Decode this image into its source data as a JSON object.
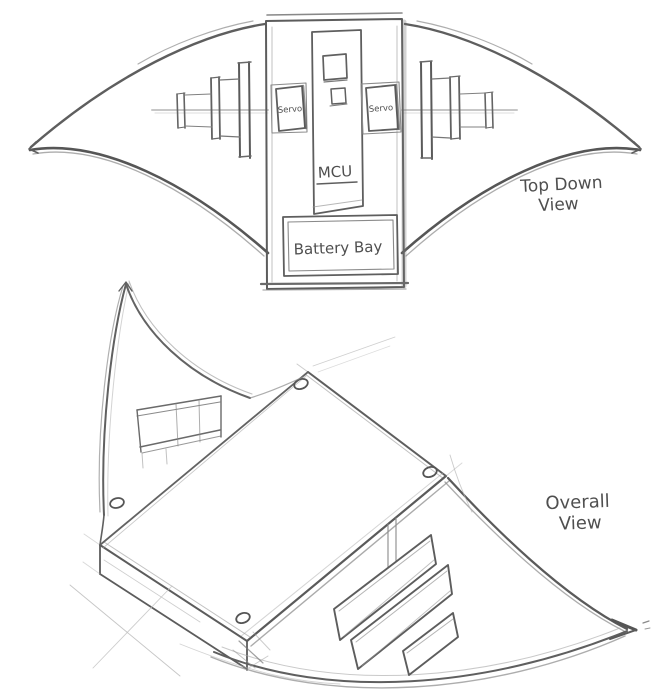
{
  "sketch": {
    "top_down_view": {
      "label_line1": "Top Down",
      "label_line2": "View",
      "servo_left_label": "Servo",
      "servo_right_label": "Servo",
      "mcu_label": "MCU",
      "battery_bay_label": "Battery Bay"
    },
    "overall_view": {
      "label_line1": "Overall",
      "label_line2": "View"
    },
    "colors": {
      "paper": "#ffffff",
      "pencil_dark": "#585858",
      "pencil_mid": "#8a8a8a",
      "pencil_light": "#b8b8b8",
      "text": "#4a4a4a"
    }
  }
}
